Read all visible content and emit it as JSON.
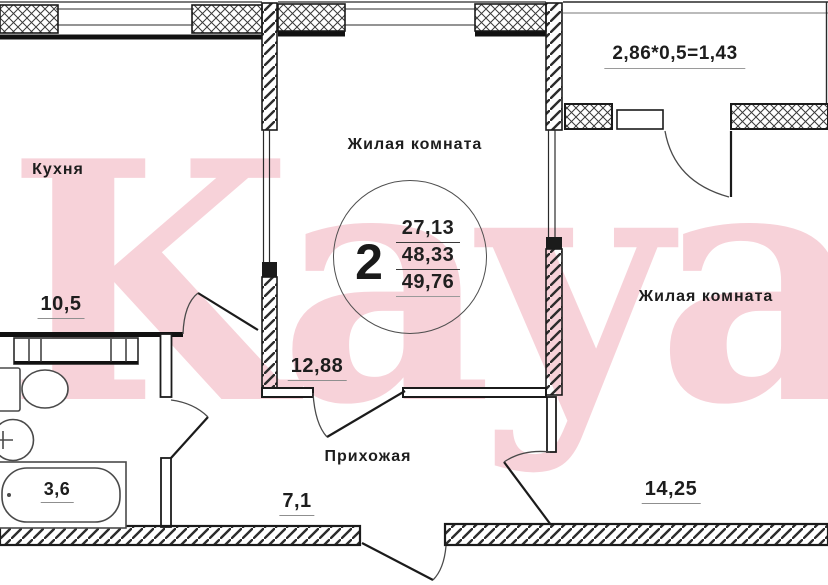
{
  "watermark": "Kayan",
  "rooms": {
    "kitchen": {
      "label": "Кухня",
      "area": "10,5"
    },
    "living1": {
      "label": "Жилая комната",
      "area": "12,88"
    },
    "living2": {
      "label": "Жилая комната",
      "area": "14,25"
    },
    "hallway": {
      "label": "Прихожая",
      "area": "7,1"
    },
    "bathroom": {
      "area": "3,6"
    }
  },
  "summary": {
    "room_count": "2",
    "living_area": "27,13",
    "area": "48,33",
    "total_area": "49,76"
  },
  "balcony": {
    "formula": "2,86*0,5=1,43"
  },
  "colors": {
    "watermark_pink": "#f7d2d9",
    "wall_line": "#1b1b1b",
    "dim_underline": "#8f8f8f"
  }
}
